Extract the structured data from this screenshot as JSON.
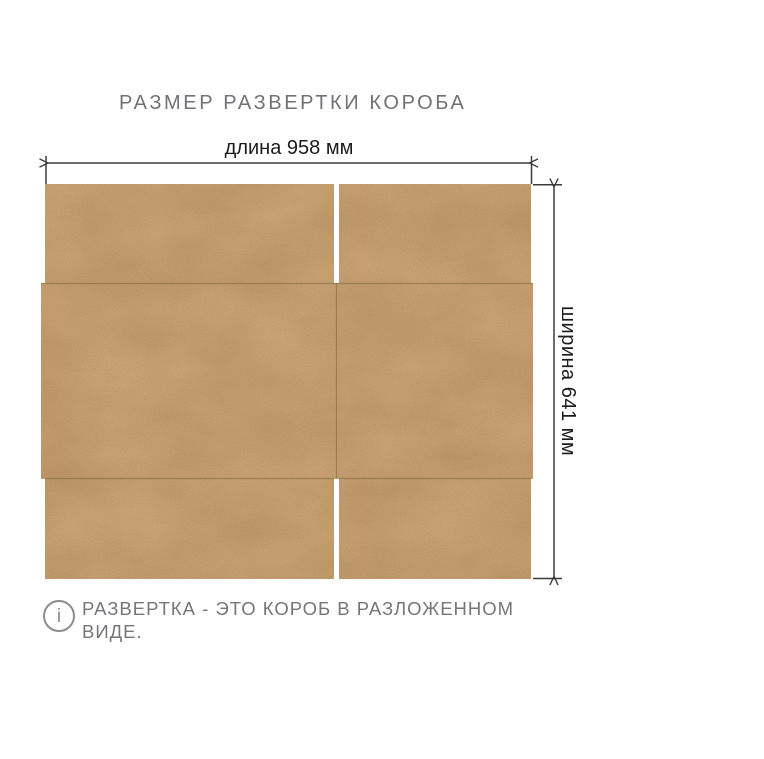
{
  "title": "РАЗМЕР РАЗВЕРТКИ КОРОБА",
  "diagram": {
    "length_label": "длина 958 мм",
    "width_label": "ширина 641 мм",
    "length_mm": 958,
    "width_mm": 641,
    "kraft_color": "#d6ae7e",
    "fold_line_color": "#7e6437",
    "dimension_line_color": "#3c3c3c",
    "cut_gap_color": "#ffffff"
  },
  "note": {
    "icon": "i",
    "lines": [
      "РАЗВЕРТКА - ЭТО КОРОБ В РАЗЛОЖЕННОМ",
      "ВИДЕ."
    ]
  },
  "colors": {
    "background": "#ffffff",
    "heading_text": "#717276",
    "note_text": "#75767a",
    "dimension_text": "#1c1c1c"
  }
}
